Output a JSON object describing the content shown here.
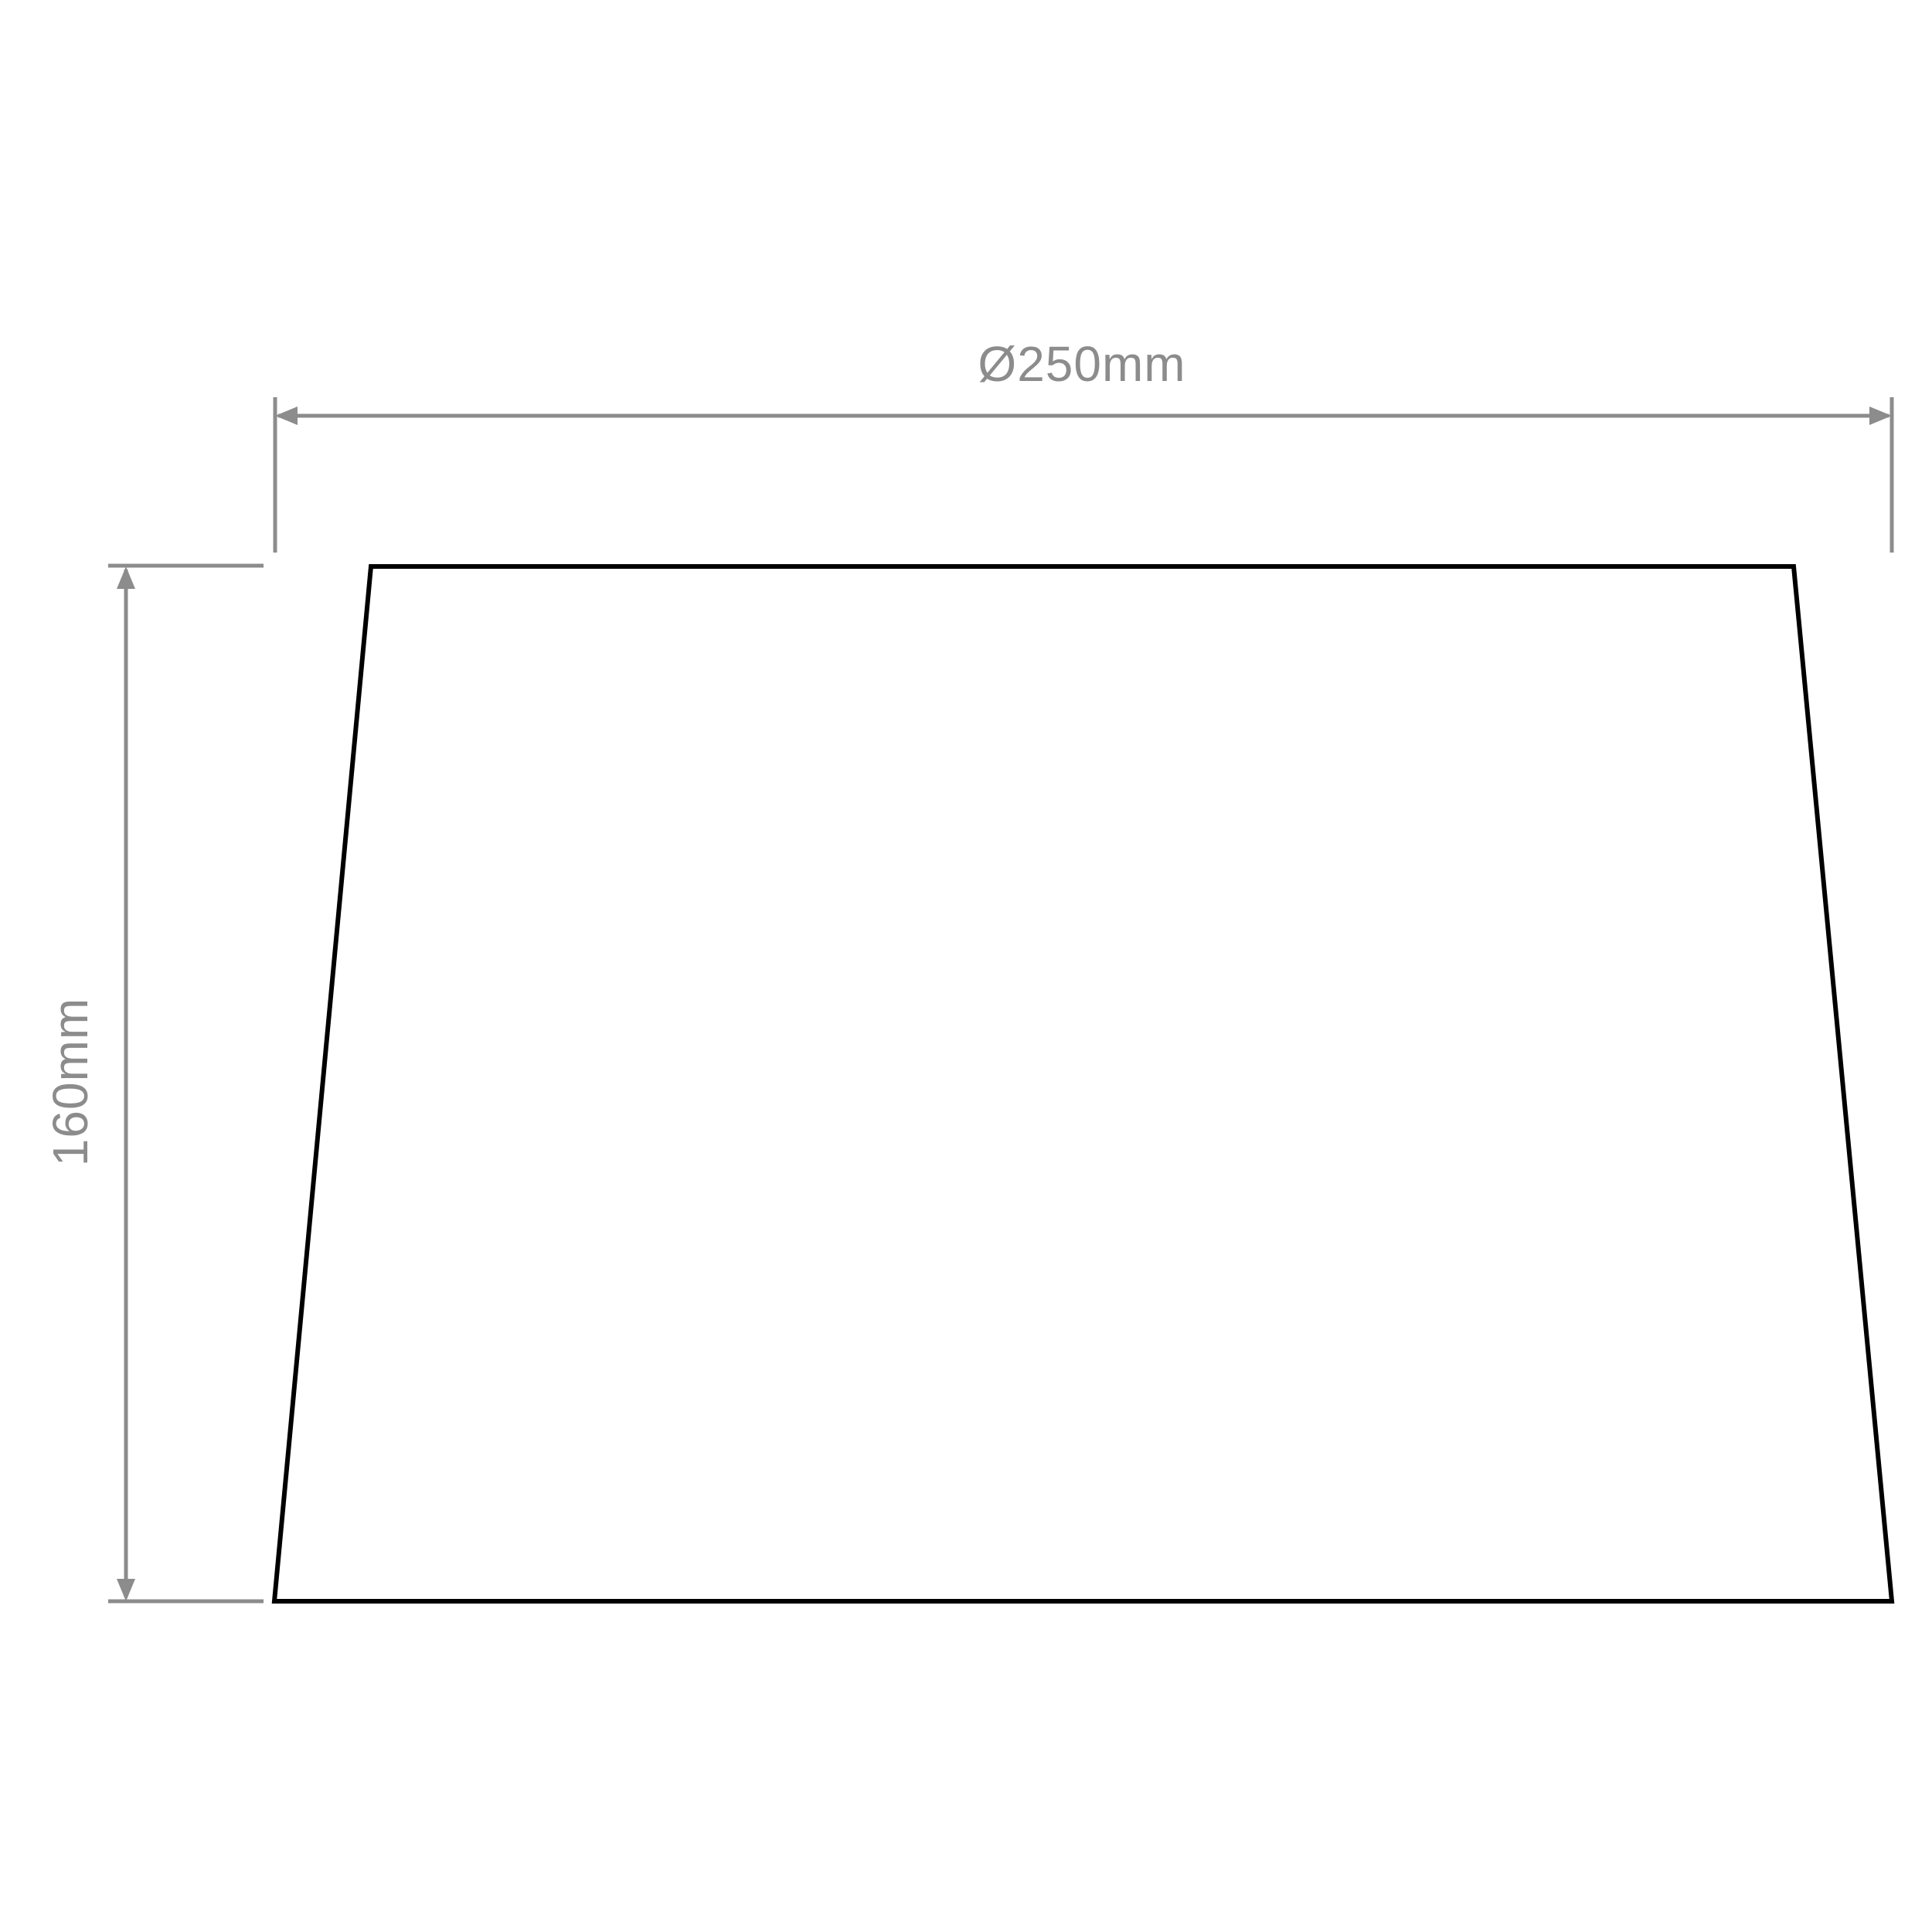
{
  "diagram": {
    "type": "technical-dimension-drawing",
    "subject": "tapered lampshade front elevation",
    "background_color": "#ffffff",
    "outline_color": "#000000",
    "dimension_color": "#8c8c8c",
    "dimensions": {
      "diameter": {
        "label": "Ø250mm",
        "value_mm": 250,
        "symbol": "Ø",
        "orientation": "horizontal",
        "measures": "bottom diameter of shade"
      },
      "height": {
        "label": "160mm",
        "value_mm": 160,
        "orientation": "vertical",
        "measures": "height of shade"
      }
    }
  }
}
